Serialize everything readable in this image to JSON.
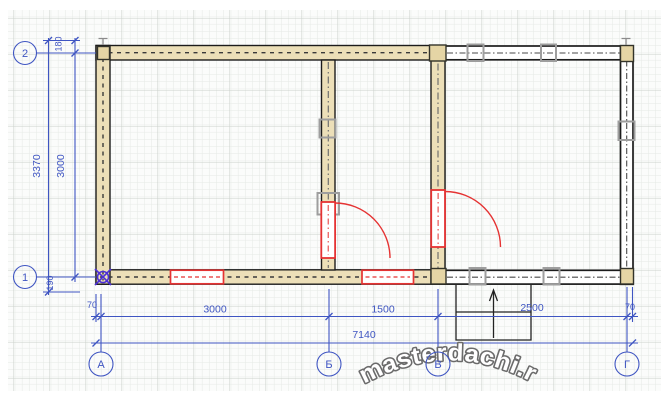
{
  "axes": {
    "left": [
      {
        "label": "2"
      },
      {
        "label": "1"
      }
    ],
    "bottom": [
      {
        "label": "А"
      },
      {
        "label": "Б"
      },
      {
        "label": "В"
      },
      {
        "label": "Г"
      }
    ]
  },
  "dimensions": {
    "left": {
      "total": "3370",
      "inner": "3000",
      "top_offset": "180",
      "bottom_offset": "190"
    },
    "bottom": {
      "left_offset": "70",
      "a_b": "3000",
      "b_v": "1500",
      "v_g": "2500",
      "right_offset": "70",
      "total": "7140"
    }
  },
  "watermark": {
    "text": "masterdachi.ru"
  },
  "colors": {
    "dimension_blue": "#3f55c2",
    "wall_fill": "#ecdfb8",
    "accent_red": "#e53333",
    "post_gray": "#9e9e9e",
    "origin_marker": "#4b2fd6",
    "grid_minor": "#e5e9e5",
    "grid_major": "#ccd2cc"
  }
}
